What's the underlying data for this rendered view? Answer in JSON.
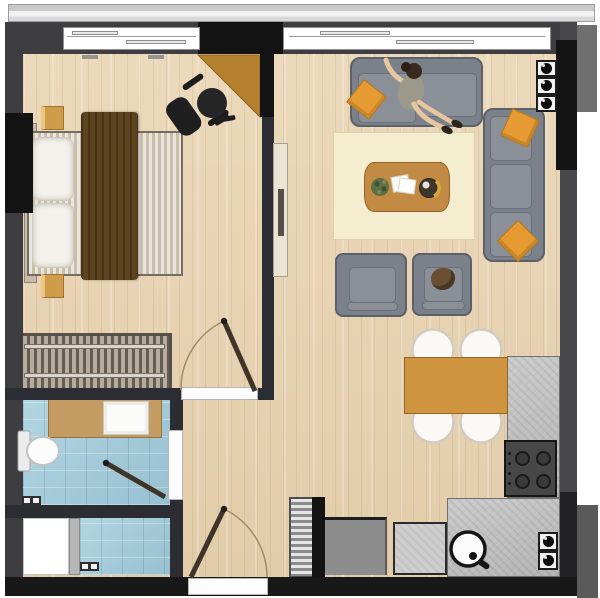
{
  "meta": {
    "type": "architectural-floor-plan",
    "title": "One-bedroom apartment floor plan, top view",
    "canvas": "600x598",
    "text_on_image": "none"
  },
  "colors": {
    "wood": "#ecd9bb",
    "woodDeep": "#e2ccaa",
    "wall": "#3e3e41",
    "wallBlack": "#131313",
    "wallInner": "#2c2c33",
    "extGray": "#6f6f6f",
    "tile": "#b3d5e2",
    "tileDeep": "#97c0d1",
    "vanity": "#c49c63",
    "headboard": "#c7bcaa",
    "mattress": "#d8d0c0",
    "pillow": "#f3f1ea",
    "blanket": "#5d441f",
    "nightstand": "#cf9c49",
    "desk": "#b5812f",
    "sofa": "#7b818a",
    "cushion": "#8b9098",
    "accent": "#e59a32",
    "rug": "#f4edcf",
    "tableWood": "#c28a43",
    "diningTable": "#cf9440",
    "counter": "#c0c0c0",
    "chairWhite": "#faf9f5",
    "doorLeaf": "#3f3428",
    "skin": "#e9c79e",
    "shirt": "#9a998c",
    "hair": "#382a1e"
  },
  "rooms": [
    {
      "id": "bedroom",
      "position": "top-left",
      "furniture": [
        "double-bed",
        "two-pillows",
        "brown-blanket",
        "headboard",
        "nightstand-top",
        "nightstand-bottom",
        "corner-desk",
        "office-chair",
        "wardrobe"
      ]
    },
    {
      "id": "bathroom",
      "position": "mid-left",
      "floor": "blue-tile",
      "furniture": [
        "toilet",
        "vanity-counter",
        "washbasin",
        "floor-vent"
      ]
    },
    {
      "id": "laundry-wc",
      "position": "bottom-left",
      "floor": "blue-tile",
      "furniture": [
        "appliance-or-shower",
        "partition-strip",
        "floor-vent"
      ]
    },
    {
      "id": "living-room",
      "position": "right",
      "furniture": [
        "two-seat-sofa",
        "person-sitting",
        "orange-pillow",
        "chaise-sofa-right",
        "orange-pillow-top",
        "orange-pillow-bottom",
        "area-rug",
        "coffee-table",
        "potted-plant",
        "magazines",
        "fruit-bowl",
        "armchair-left",
        "armchair-right",
        "brown-bag-on-armchair",
        "tv-sideboard"
      ]
    },
    {
      "id": "kitchen-dining",
      "position": "bottom-right",
      "furniture": [
        "dining-table",
        "dining-chair x4",
        "l-shaped-counter",
        "four-burner-stove",
        "round-sink",
        "appliance-cabinet",
        "service-shaft-top x3",
        "service-shaft-bottom x2"
      ]
    },
    {
      "id": "entry-hall",
      "position": "bottom-center",
      "furniture": [
        "radiator",
        "shoe-cabinet",
        "entrance-door"
      ]
    }
  ],
  "openings": {
    "windows": [
      "bedroom-window-top",
      "living-room-window-top"
    ],
    "doors": [
      "bedroom-door-swing",
      "bathroom-door-swing",
      "entrance-door-swing"
    ]
  },
  "annotations": {
    "balcony-ledge": "light gray band across top edge"
  }
}
